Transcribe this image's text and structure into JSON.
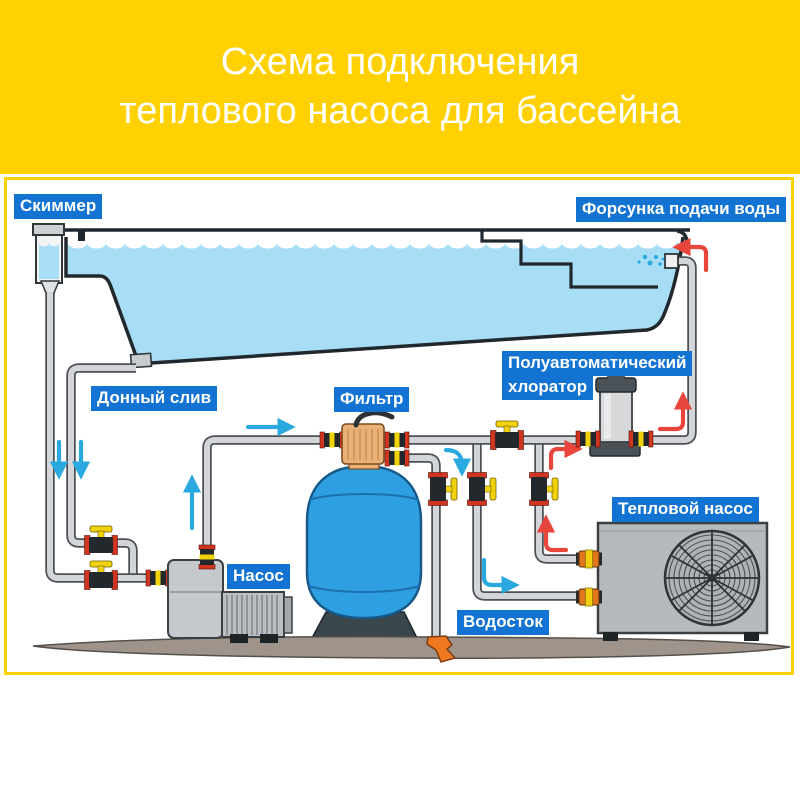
{
  "title": {
    "line1": "Схема подключения",
    "line2": "теплового насоса для бассейна"
  },
  "labels": {
    "skimmer": "Скиммер",
    "inlet_nozzle": "Форсунка подачи воды",
    "bottom_drain": "Донный слив",
    "filter": "Фильтр",
    "chlorinator_line1": "Полуавтоматический",
    "chlorinator_line2": "хлоратор",
    "pump": "Насос",
    "drain": "Водосток",
    "heat_pump": "Тепловой насос"
  },
  "colors": {
    "header_bg": "#ffd103",
    "frame_border": "#ffd103",
    "label_bg": "#1273d2",
    "label_text": "#ffffff",
    "pool_water": "#a8def5",
    "outline": "#20282e",
    "pipe": "#d3d5d8",
    "filter_tank": "#2ea0e2",
    "multiport_valve": "#e9b077",
    "valve_handle_yellow": "#f2d30b",
    "valve_ring_red": "#d2351f",
    "cold_flow_arrow": "#2aa9e0",
    "hot_flow_arrow": "#e8453c",
    "ground": "#9f948b",
    "drain_funnel": "#f07820",
    "equipment_gray": "#bcbfc1"
  }
}
